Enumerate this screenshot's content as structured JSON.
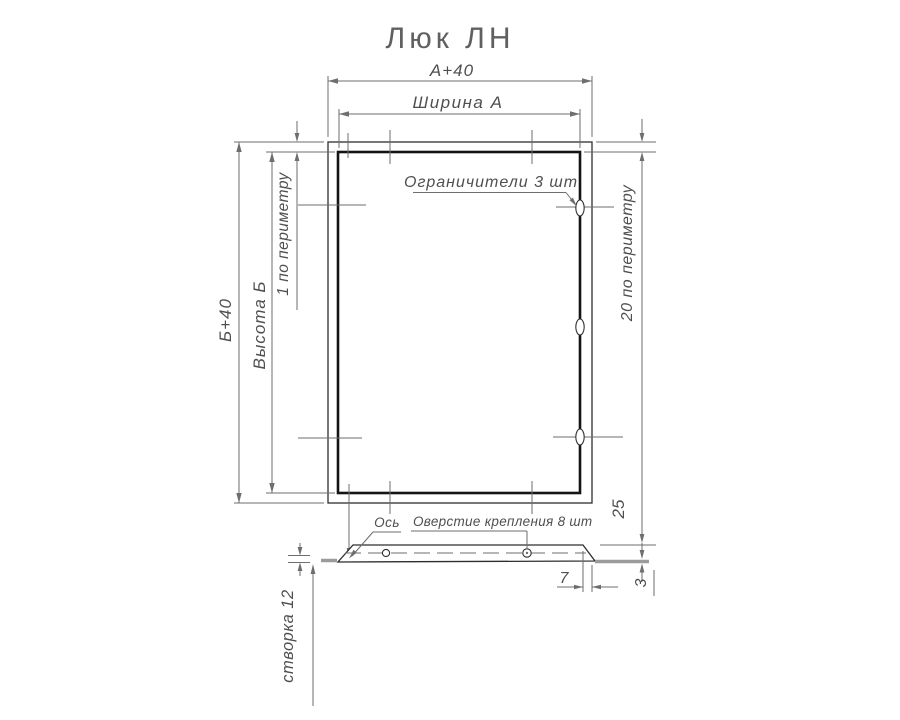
{
  "title": "Люк ЛН",
  "colors": {
    "line": "#2e2e2e",
    "thick": "#141414",
    "dim": "#6e6e6e",
    "text": "#4f4f4f",
    "title": "#606060",
    "flange": "#9b9b9b"
  },
  "front_view": {
    "dims": {
      "outer_width": "А+40",
      "inner_width": "Ширина А",
      "outer_height": "Б+40",
      "inner_height": "Высота Б",
      "gap_note": "1  по  периметру",
      "frame_note": "20  по  периметру"
    },
    "limiters_label": "Ограничители 3  шт",
    "limiters_count": 3
  },
  "section_view": {
    "axis_label": "Ось",
    "holes_label": "Оверстие  крепления  8  шт",
    "holes_count": 8,
    "dim_drop": "25",
    "dim_bevel": "7",
    "dim_flange_thickness": "3",
    "leaf_label": "створка 12"
  }
}
